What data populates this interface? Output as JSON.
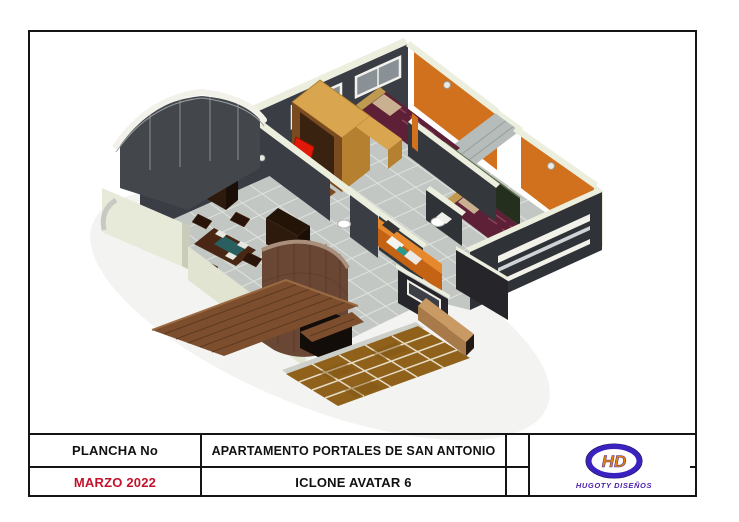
{
  "title_block": {
    "plancha_label": "PLANCHA No",
    "date": "MARZO 2022",
    "project_title": "APARTAMENTO PORTALES DE SAN ANTONIO",
    "subtitle": "ICLONE AVATAR 6",
    "logo": {
      "monogram": "HD",
      "company": "HUGOTY DISEÑOS"
    }
  },
  "scene": {
    "type": "3d-isometric-apartment-render"
  },
  "palette": {
    "frame_black": "#151515",
    "date_red": "#c3132b",
    "logo_purple": "#3a22c0",
    "logo_orange": "#e8820a",
    "logo_text_purple": "#4a1fa8",
    "shadow": "#e8e8e6",
    "floor": "#c3c7c3",
    "tile_line": "#dfe2de",
    "wall_dark": "#3a3e44",
    "wall_darker": "#2f3237",
    "wall_cream": "#eceede",
    "cream_face": "#e7e9d9",
    "cream_face2": "#e2e4d2",
    "glass": "#8a9196",
    "white": "#f2f2ea",
    "orange": "#d2711d",
    "orange_dark": "#c56315",
    "orange_top": "#e8882c",
    "bed": "#5d2036",
    "bed_pattern": "#8a4258",
    "pillow": "#c8b090",
    "headboard": "#c09a50",
    "blanket": "#c8a868",
    "green_closet": "#242f1e",
    "wood_light": "#d9a54e",
    "wood_mid": "#b5802f",
    "wood_dark": "#7a4a20",
    "wood_panel": "#3a2210",
    "cabinet": "#2e1a0c",
    "table": "#4a2615",
    "teal": "#2a5f5f",
    "chair_red": "#e01808",
    "curve_wall": "#6a4634",
    "curve_rim": "#a98f7c",
    "opening": "#120d09",
    "deck": "#7d4e2e",
    "deck_line": "#5c3a20",
    "terrace": "#90611a",
    "terrace_line": "#e6ddc8",
    "beam": "#c99a64",
    "beam_front": "#a87a4a"
  }
}
